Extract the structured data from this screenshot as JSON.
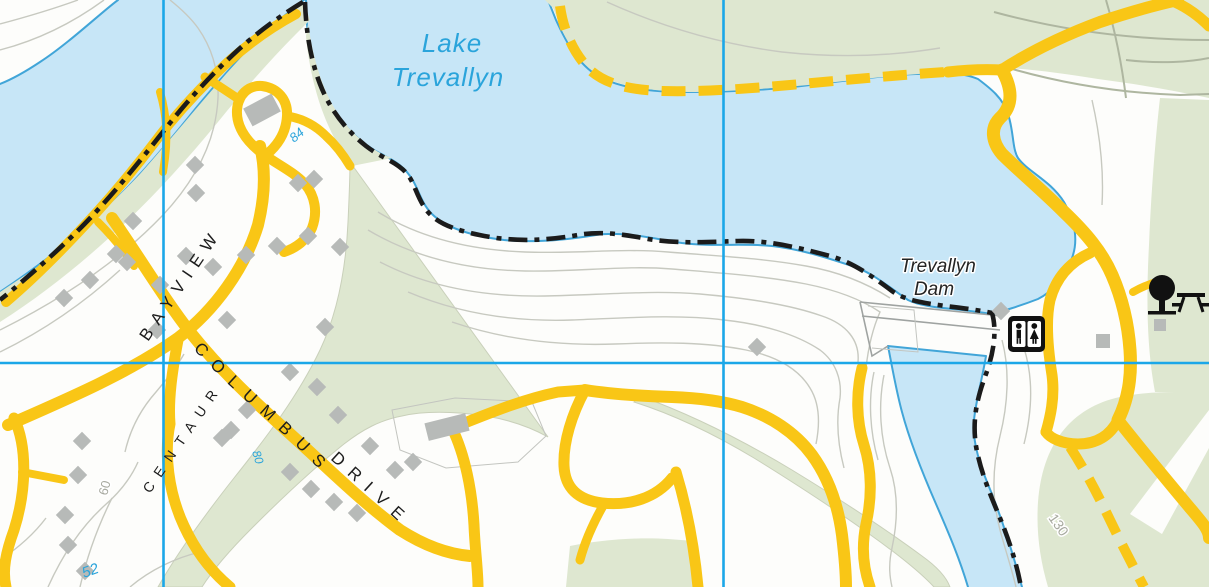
{
  "map": {
    "labels": {
      "lake1": "Lake",
      "lake2": "Trevallyn",
      "dam1": "Trevallyn",
      "dam2": "Dam"
    },
    "road_labels": {
      "bayview": "BAYVIEW",
      "columbus": "COLUMBUS",
      "drive": "DRIVE",
      "centaur": "CENTAUR"
    },
    "spot_heights": {
      "h84": "84",
      "h80": "80",
      "h52": "52"
    },
    "contour_labels": {
      "c60": "60",
      "c130": "130"
    },
    "icons": {
      "toilets": "toilets-icon",
      "picnic": "picnic-area-icon"
    },
    "colors": {
      "water": "#C7E6F7",
      "shore": "#41A5D8",
      "vegetation": "#DEE7D0",
      "road": "#F9C616",
      "contour": "#C7C9C0",
      "track": "#AEB6A0",
      "grid": "#1BA7E8",
      "boundary": "#1B1B1B",
      "building": "#B7BAB8",
      "label_water": "#2AA4DB"
    }
  }
}
